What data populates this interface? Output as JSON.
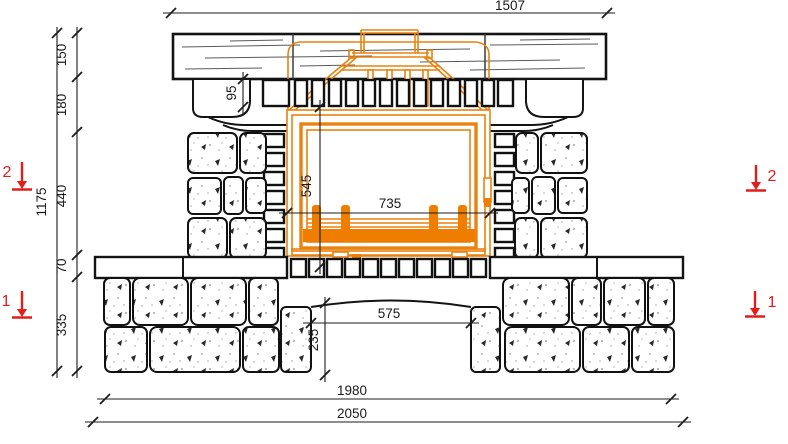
{
  "drawing": {
    "dims": {
      "top_width": "1507",
      "overall_height": "1175",
      "beam_height": "150",
      "frieze_height": "180",
      "firebox_zone_height": "440",
      "bench_slab_height": "70",
      "base_height": "335",
      "grille_height": "95",
      "door_height": "545",
      "door_width": "735",
      "niche_width": "575",
      "niche_height": "235",
      "footprint_width": "1980",
      "overall_width": "2050"
    },
    "markers": {
      "section2_left": "2",
      "section1_left": "1",
      "section2_right": "2",
      "section1_right": "1"
    },
    "colors": {
      "ink": "#141414",
      "insert_orange": "#e9820e",
      "insert_orange_fill": "#ef7d00",
      "section_red": "#e21d1a"
    }
  }
}
